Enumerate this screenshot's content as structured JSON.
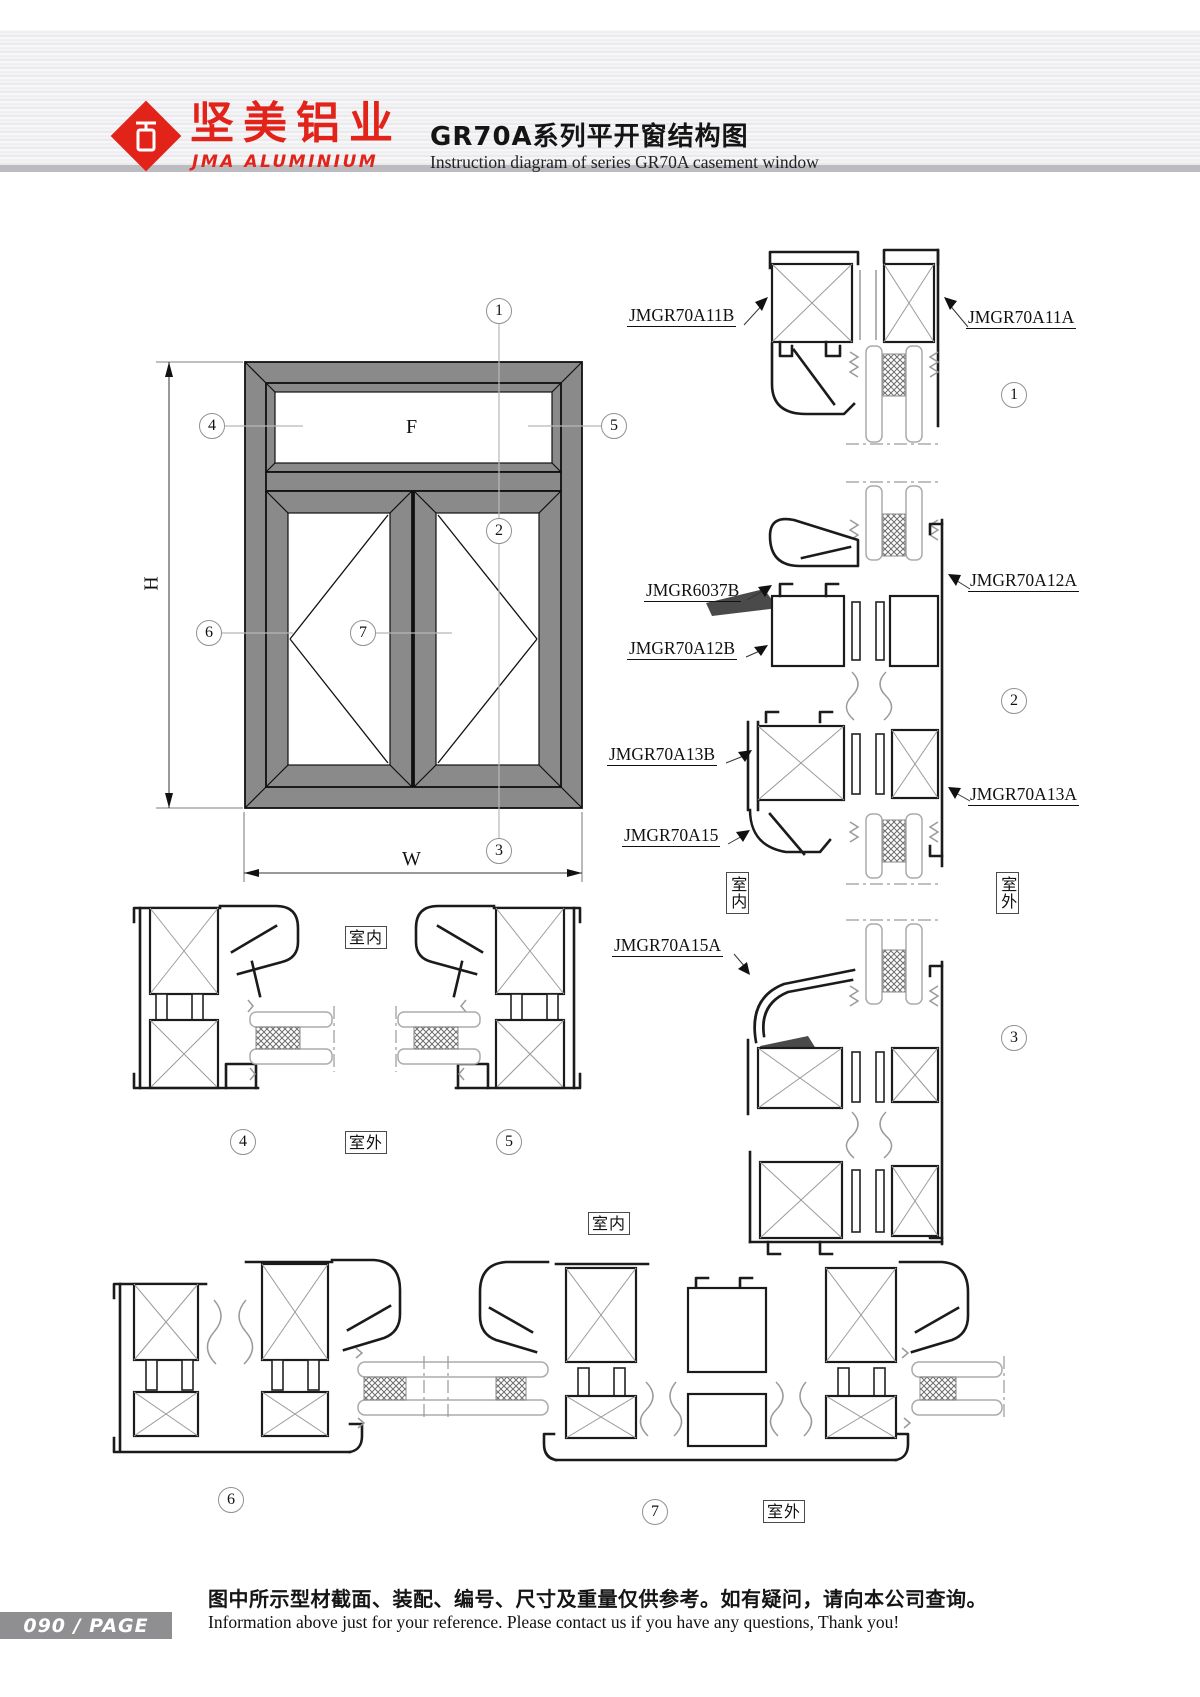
{
  "header": {
    "brand": {
      "cn": "坚美铝业",
      "en": "JMA ALUMINIUM"
    },
    "title_cn": "GR70A系列平开窗结构图",
    "title_en": "Instruction diagram of series GR70A casement window"
  },
  "elevation": {
    "h": "H",
    "w": "W",
    "f": "F"
  },
  "callouts": {
    "n1": "1",
    "n2": "2",
    "n3": "3",
    "n4": "4",
    "n5": "5",
    "n6": "6",
    "n7": "7"
  },
  "parts": {
    "a11b": "JMGR70A11B",
    "a11a": "JMGR70A11A",
    "b6037": "JMGR6037B",
    "a12a": "JMGR70A12A",
    "a12b": "JMGR70A12B",
    "a13b": "JMGR70A13B",
    "a13a": "JMGR70A13A",
    "a15": "JMGR70A15",
    "a15a": "JMGR70A15A"
  },
  "loc": {
    "indoor": "室内",
    "outdoor": "室外"
  },
  "footer": {
    "page": "090  /  PAGE",
    "note_cn": "图中所示型材截面、装配、编号、尺寸及重量仅供参考。如有疑问，请向本公司查询。",
    "note_en": "Information above just for your reference. Please contact us if you have any questions, Thank you!"
  }
}
